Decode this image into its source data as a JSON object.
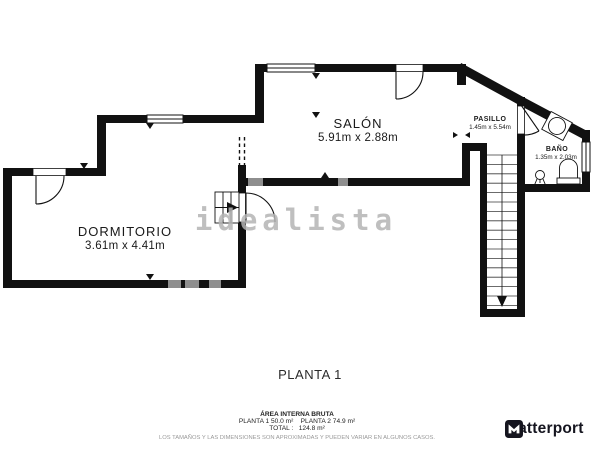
{
  "rooms": [
    {
      "name": "SALÓN",
      "dims": "5.91m x 2.88m"
    },
    {
      "name": "DORMITORIO",
      "dims": "3.61m x 4.41m"
    },
    {
      "name": "PASILLO",
      "dims": "1.45m x 5.54m"
    },
    {
      "name": "BAÑO",
      "dims": "1.35m x 2.03m"
    }
  ],
  "floor_label": "PLANTA 1",
  "watermark": "idealista",
  "footer": {
    "area_title": "ÁREA INTERNA BRUTA",
    "area_line": "PLANTA 1 50.0 m²    PLANTA 2 74.9 m²",
    "total_line": "TOTAL :   124.8 m²",
    "disclaimer": "LOS TAMAÑOS Y LAS DIMENSIONES SON APROXIMADAS Y PUEDEN VARIAR EN ALGUNOS CASOS."
  },
  "branding": {
    "logo_text": "Matterport"
  },
  "colors": {
    "wall": "#111111",
    "gray_wall_segment": "#8e8e8e",
    "watermark": "#b4b4b4",
    "disclaimer_text": "#9a9a9a",
    "logo": "#15151f"
  }
}
